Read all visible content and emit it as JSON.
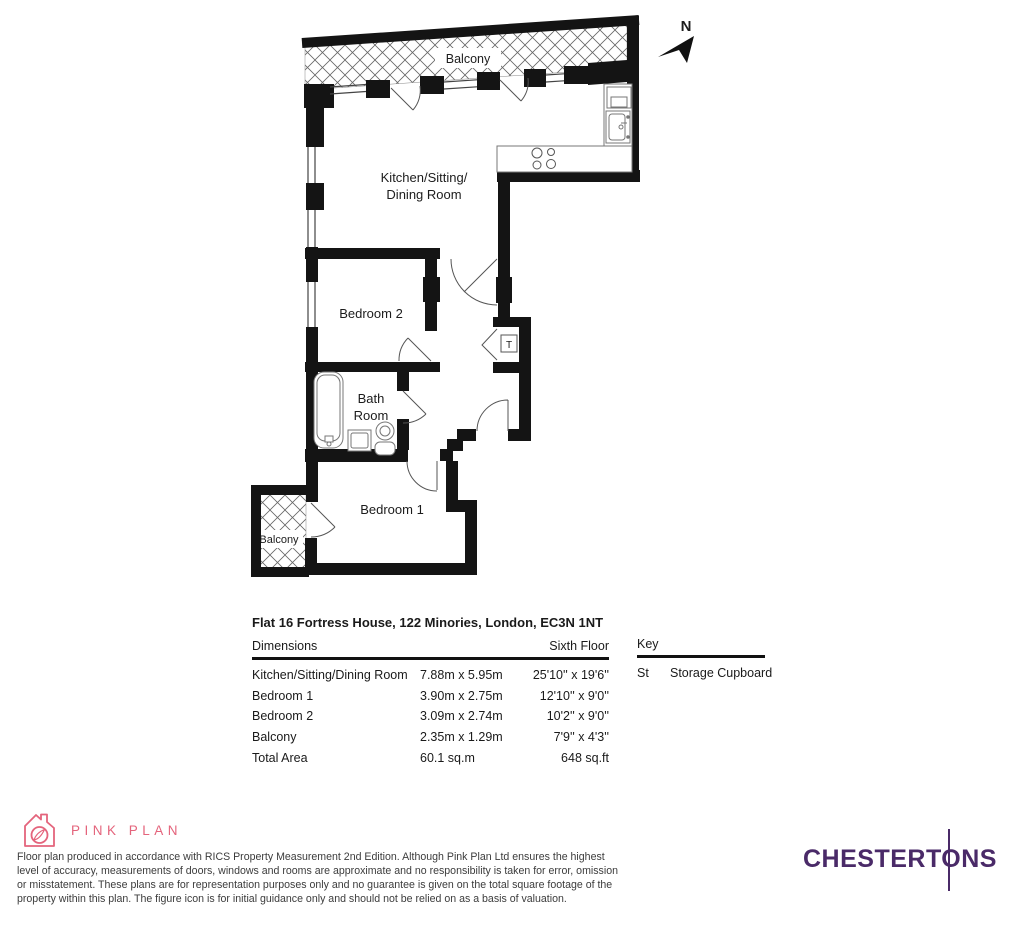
{
  "floor_plan": {
    "north_label": "N",
    "rooms": {
      "balcony_top": "Balcony",
      "kitchen_line1": "Kitchen/Sitting/",
      "kitchen_line2": "Dining Room",
      "bedroom2": "Bedroom 2",
      "bath_line1": "Bath",
      "bath_line2": "Room",
      "bedroom1": "Bedroom 1",
      "balcony_bottom": "Balcony",
      "tank_label": "T"
    }
  },
  "details": {
    "title": "Flat 16 Fortress House, 122 Minories, London, EC3N 1NT",
    "dimensions_label": "Dimensions",
    "floor_label": "Sixth Floor",
    "rows": [
      {
        "name": "Kitchen/Sitting/Dining Room",
        "metric": "7.88m x 5.95m",
        "imperial": "25'10'' x 19'6''"
      },
      {
        "name": "Bedroom 1",
        "metric": "3.90m x 2.75m",
        "imperial": "12'10'' x 9'0''"
      },
      {
        "name": "Bedroom 2",
        "metric": "3.09m x 2.74m",
        "imperial": "10'2'' x 9'0''"
      },
      {
        "name": "Balcony",
        "metric": "2.35m x 1.29m",
        "imperial": "7'9'' x 4'3''"
      },
      {
        "name": "Total Area",
        "metric": "60.1 sq.m",
        "imperial": "648 sq.ft"
      }
    ],
    "key": {
      "title": "Key",
      "abbr": "St",
      "meaning": "Storage Cupboard"
    }
  },
  "footer": {
    "pinkplan_label": "PINK PLAN",
    "disclaimer": "Floor plan produced in accordance with RICS Property Measurement 2nd Edition. Although Pink Plan Ltd ensures the highest\nlevel of accuracy, measurements of doors, windows and rooms are approximate and no responsibility is taken for error, omission\nor misstatement. These plans are for representation purposes only and no guarantee is given on the total square footage of the\nproperty within this plan. The figure icon is for initial guidance only and should not be relied on as a basis of valuation.",
    "brand": "CHESTERTONS"
  },
  "colors": {
    "pink": "#e4647c",
    "purple": "#4a2a68",
    "wall": "#141414"
  }
}
